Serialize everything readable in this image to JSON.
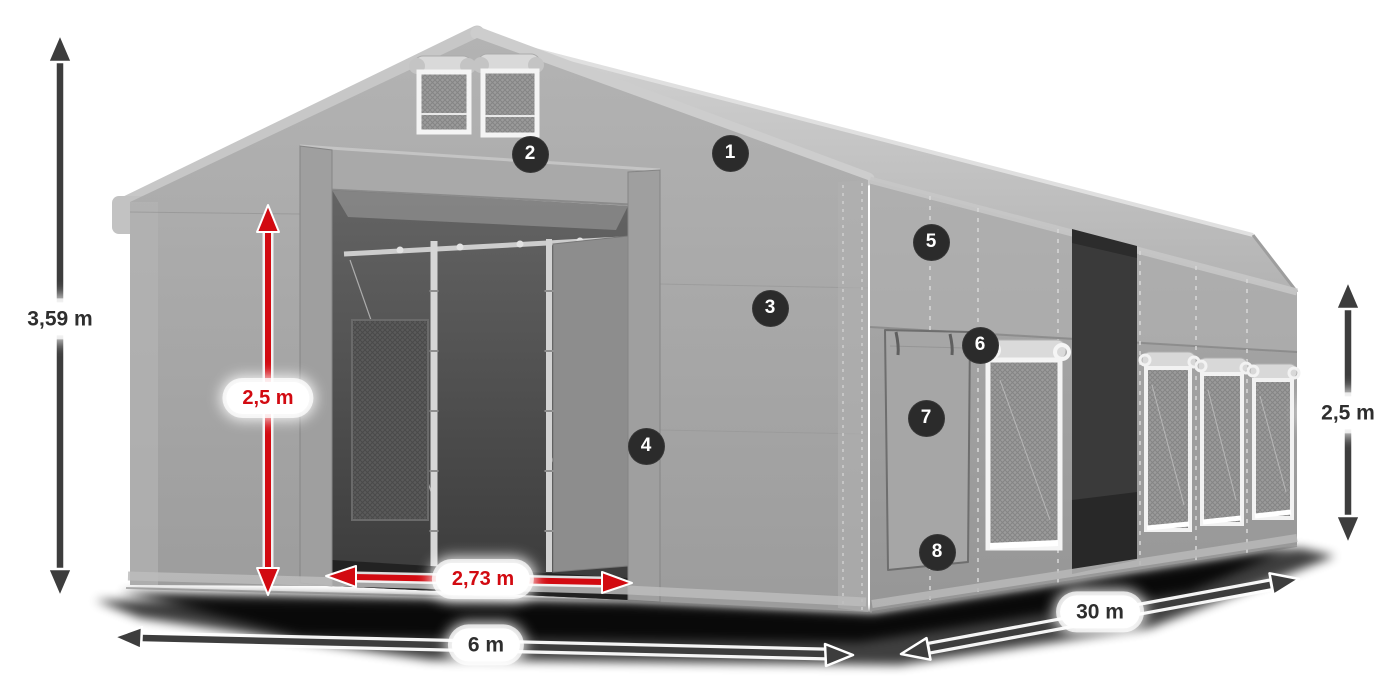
{
  "diagram": {
    "type": "product-dimension-diagram",
    "subject": "grey storage tent 3D render with dimension arrows and numbered feature callouts",
    "dimensions": {
      "total_height": {
        "label": "3,59 m",
        "style": "dark",
        "meaning": "overall ridge height"
      },
      "entrance_height": {
        "label": "2,5 m",
        "style": "red",
        "meaning": "entrance clear height"
      },
      "entrance_width": {
        "label": "2,73 m",
        "style": "red",
        "meaning": "entrance clear width"
      },
      "width": {
        "label": "6 m",
        "style": "dark",
        "meaning": "gable end width"
      },
      "length": {
        "label": "30 m",
        "style": "dark",
        "meaning": "side wall length"
      },
      "side_height": {
        "label": "2,5 m",
        "style": "dark",
        "meaning": "side wall height"
      }
    },
    "callouts": [
      {
        "number": "1"
      },
      {
        "number": "2"
      },
      {
        "number": "3"
      },
      {
        "number": "4"
      },
      {
        "number": "5"
      },
      {
        "number": "6"
      },
      {
        "number": "7"
      },
      {
        "number": "8"
      }
    ],
    "colors": {
      "background": "#ffffff",
      "arrow_dark": "#3d3d3d",
      "arrow_red": "#d20a11",
      "label_bg": "#ffffff",
      "label_text_dark": "#2e2e2e",
      "label_text_red": "#d20a11",
      "badge_bg": "#2b2b2b",
      "badge_text": "#ffffff",
      "tent_grey_light": "#c9c9c9",
      "tent_grey": "#a5a5a5",
      "tent_grey_dark": "#8f8f8f",
      "interior_dark": "#454545"
    }
  }
}
